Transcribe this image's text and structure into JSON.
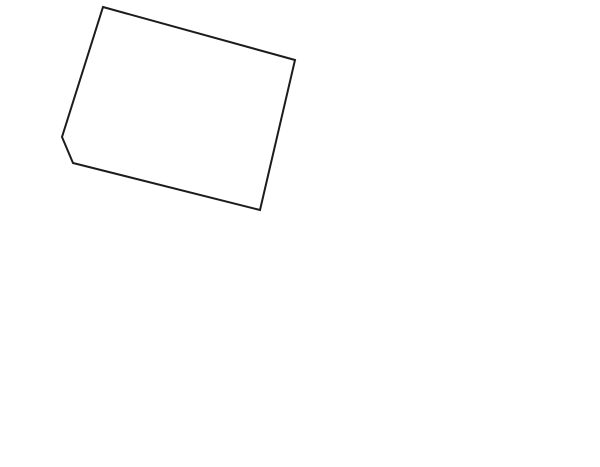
{
  "page": {
    "background": "#ffffff",
    "description": "residential lot plat map"
  },
  "compass": {
    "name": "north-arrow",
    "cx": 563,
    "cy": 30,
    "r": 26,
    "ring_width": 5,
    "ring_color": "#000000",
    "arrow_color": "#000000"
  },
  "map": {
    "stroke": "#1c1c1c",
    "stroke_width": 2,
    "colors": {
      "parcel_white": "#ffffff",
      "road_gray": "#c3c3c3",
      "lot_yellow": "#f9f5c7",
      "zoning_blue": "#1a1ad2",
      "label_black": "#111111",
      "badge_text_white": "#ffffff"
    },
    "parcels": [
      {
        "id": "parcel-upper-left",
        "fill": "#ffffff",
        "points": "103,7 295,60 260,210 73,163 62,137",
        "badge": {
          "label": "商",
          "cx": 183,
          "cy": 104,
          "r": 28,
          "fill": "#1a1ad2",
          "font_size": 38
        }
      },
      {
        "id": "parcel-upper-right",
        "fill": "#ffffff",
        "points": "295,60 495,115 437,260 260,210",
        "badge": {
          "label": "商",
          "cx": 372,
          "cy": 159,
          "r": 28,
          "fill": "#1a1ad2",
          "font_size": 38
        }
      },
      {
        "id": "road-strip",
        "fill": "#c3c3c3",
        "points": "62,137 73,163 260,210 437,260 423,313 60,213 42,226"
      },
      {
        "id": "lot-3",
        "fill": "#f9f5c7",
        "points": "42,226 60,213 228,261 190,400 128,399 18,427 15,427 16,412 7,408",
        "label": {
          "text": "3号地",
          "x": 122,
          "y": 318,
          "font_size": 30,
          "letter_spacing": 2
        }
      },
      {
        "id": "lot-4",
        "fill": "#f9f5c7",
        "points": "228,261 423,313 378,463 335,442 190,400",
        "label": {
          "text": "4号地",
          "x": 312,
          "y": 360,
          "font_size": 30,
          "letter_spacing": 2
        }
      },
      {
        "id": "gray-sliver",
        "fill": "#c3c3c3",
        "points": "7,408 16,412 15,427 3,428"
      }
    ]
  }
}
